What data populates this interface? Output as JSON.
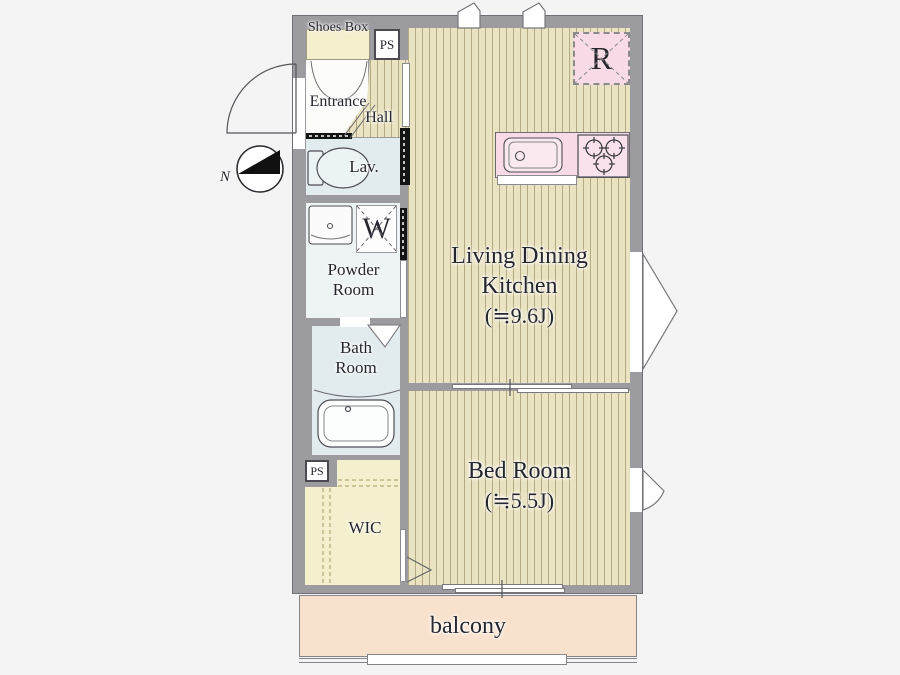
{
  "colors": {
    "paper": "#f4f4f5",
    "wall": "#9c9ba0",
    "wall_edge": "#6f6f75",
    "floor": "#eae3c2",
    "floor_stripe": "#b3a982",
    "cream": "#f4efcc",
    "water": "#e2ebee",
    "powder_fill": "#eef3f4",
    "pink": "#f8dbe6",
    "balcony": "#f9e2cd",
    "door_black": "#141414",
    "text": "#26262e"
  },
  "compass": {
    "north_label": "N"
  },
  "plan": {
    "upper_left": {
      "shoes_box": "Shoes Box",
      "ps": "PS",
      "entrance": "Entrance",
      "hall": "Hall"
    },
    "sanitary": {
      "lav": "Lav.",
      "washer": "W",
      "powder_line1": "Powder",
      "powder_line2": "Room",
      "bath_line1": "Bath",
      "bath_line2": "Room"
    },
    "storage": {
      "ps": "PS",
      "wic": "WIC"
    },
    "kitchen": {
      "refrigerator": "R"
    },
    "ldk": {
      "line1": "Living Dining",
      "line2": "Kitchen",
      "area": "(≒9.6J)"
    },
    "bedroom": {
      "name": "Bed Room",
      "area": "(≒5.5J)"
    },
    "balcony": {
      "label": "balcony"
    }
  }
}
